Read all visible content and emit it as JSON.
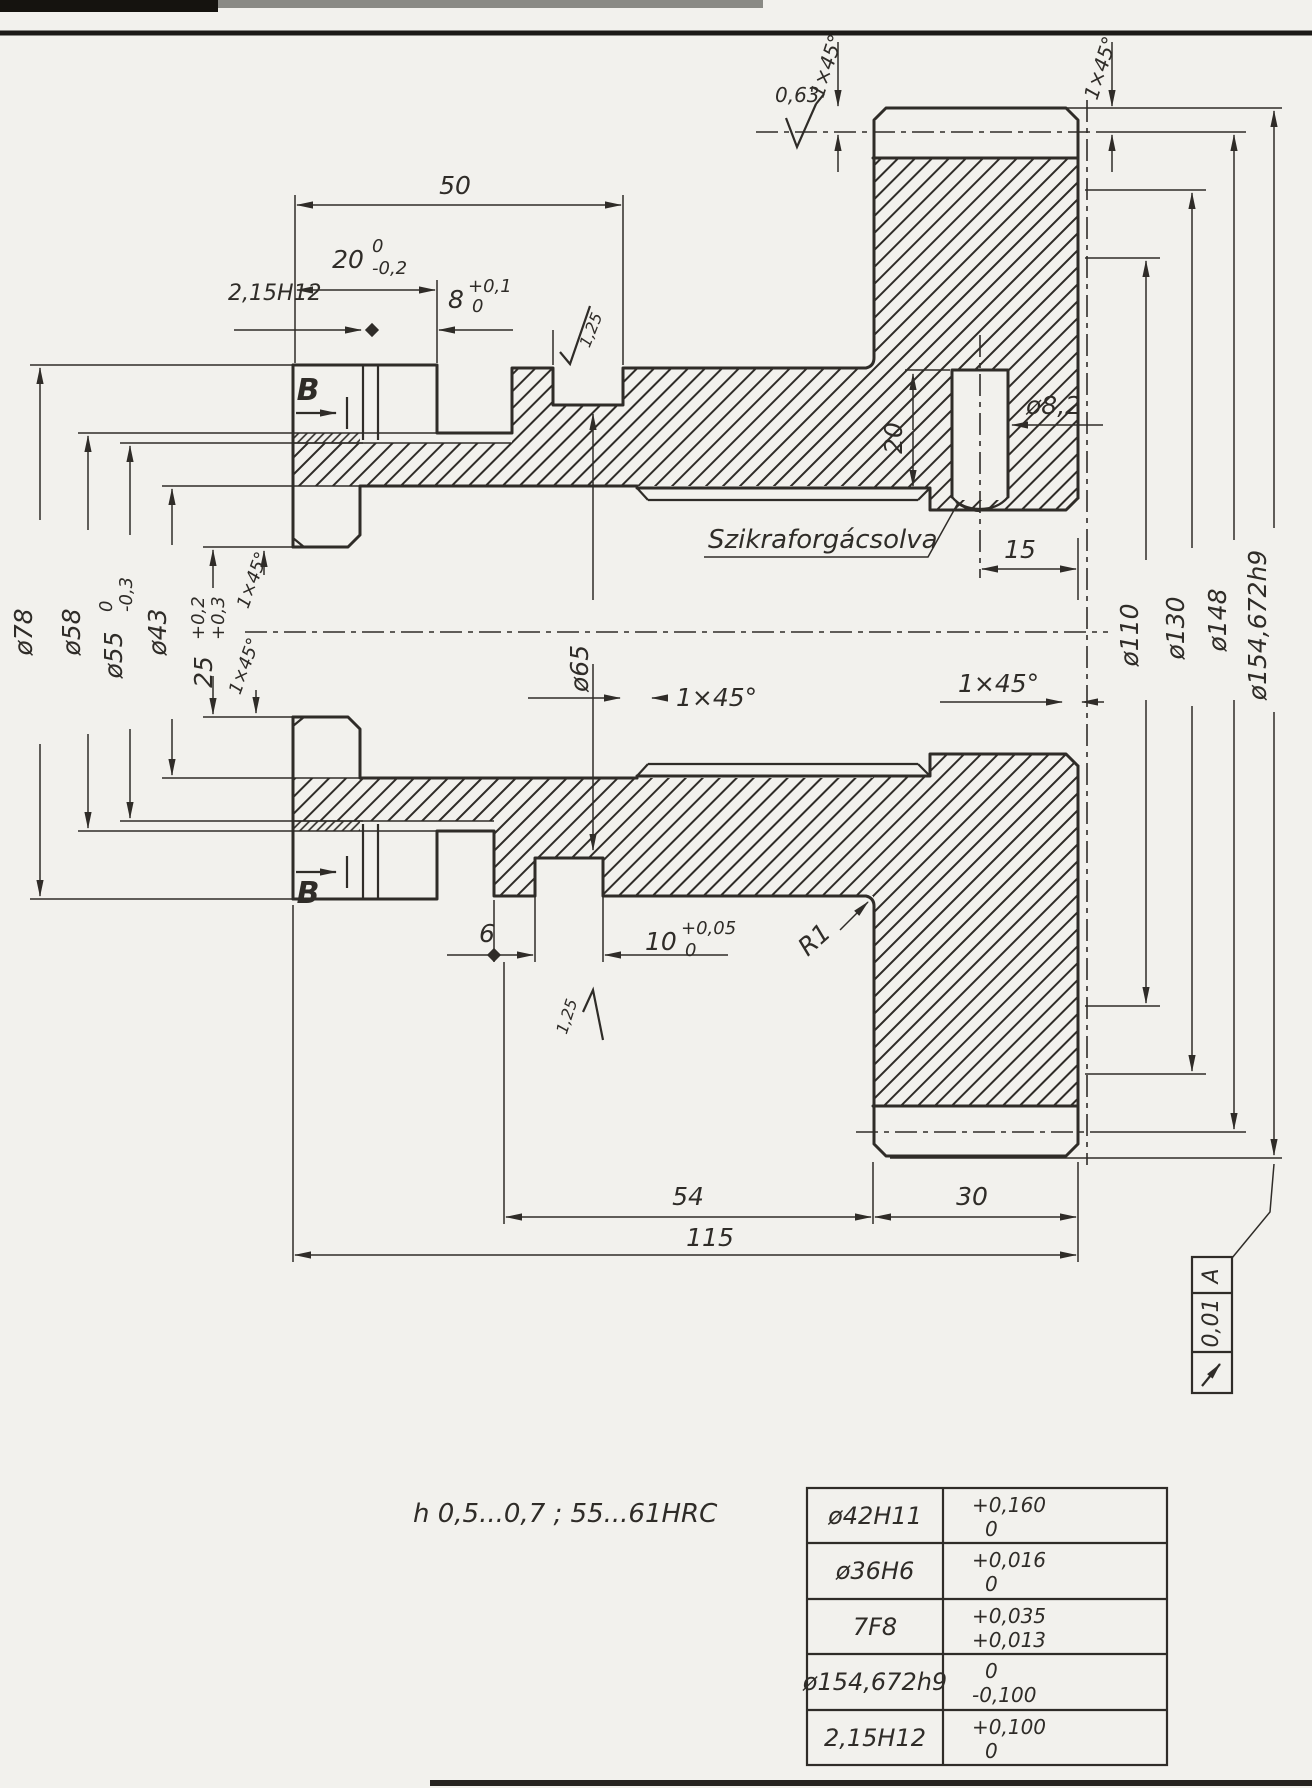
{
  "colors": {
    "paper": "#f2f1ed",
    "ink": "#2f2c28"
  },
  "drawing": {
    "note": "h 0,5...0,7 ;  55...61HRC",
    "surface_note": "Szikraforgácsolva",
    "section_label": "B",
    "dims": {
      "fifty": "50",
      "twenty": "20",
      "twenty_up": "0",
      "twenty_lo": "-0,2",
      "groove": "2,15H12",
      "eight": "8",
      "eight_up": "+0,1",
      "eight_lo": "0",
      "dia78": "ø78",
      "dia58": "ø58",
      "dia55": "ø55",
      "dia55_up": "0",
      "dia55_lo": "-0,3",
      "dia43": "ø43",
      "twentyfive": "25",
      "twentyfive_up": "+0,2",
      "twentyfive_lo": "+0,3",
      "chamfer": "1×45°",
      "dia65": "ø65",
      "hole_depth": "20",
      "hole_dia": "ø8,2",
      "fifteen": "15",
      "dia110": "ø110",
      "dia130": "ø130",
      "dia148": "ø148",
      "dia154": "ø154,672h9",
      "six": "6",
      "ten": "10",
      "ten_up": "+0,05",
      "ten_lo": "0",
      "radius": "R1",
      "fiftyfour": "54",
      "thirty": "30",
      "onefifteen": "115"
    },
    "finish": {
      "f125": "1,25",
      "f063": "0,63"
    },
    "frame": {
      "tolerance": "0,01",
      "datum": "A"
    },
    "table": {
      "rows": [
        {
          "feature": "ø42H11",
          "upper": "+0,160",
          "lower": "0"
        },
        {
          "feature": "ø36H6",
          "upper": "+0,016",
          "lower": "0"
        },
        {
          "feature": "7F8",
          "upper": "+0,035",
          "lower": "+0,013"
        },
        {
          "feature": "ø154,672h9",
          "upper": "0",
          "lower": "-0,100"
        },
        {
          "feature": "2,15H12",
          "upper": "+0,100",
          "lower": "0"
        }
      ]
    }
  }
}
